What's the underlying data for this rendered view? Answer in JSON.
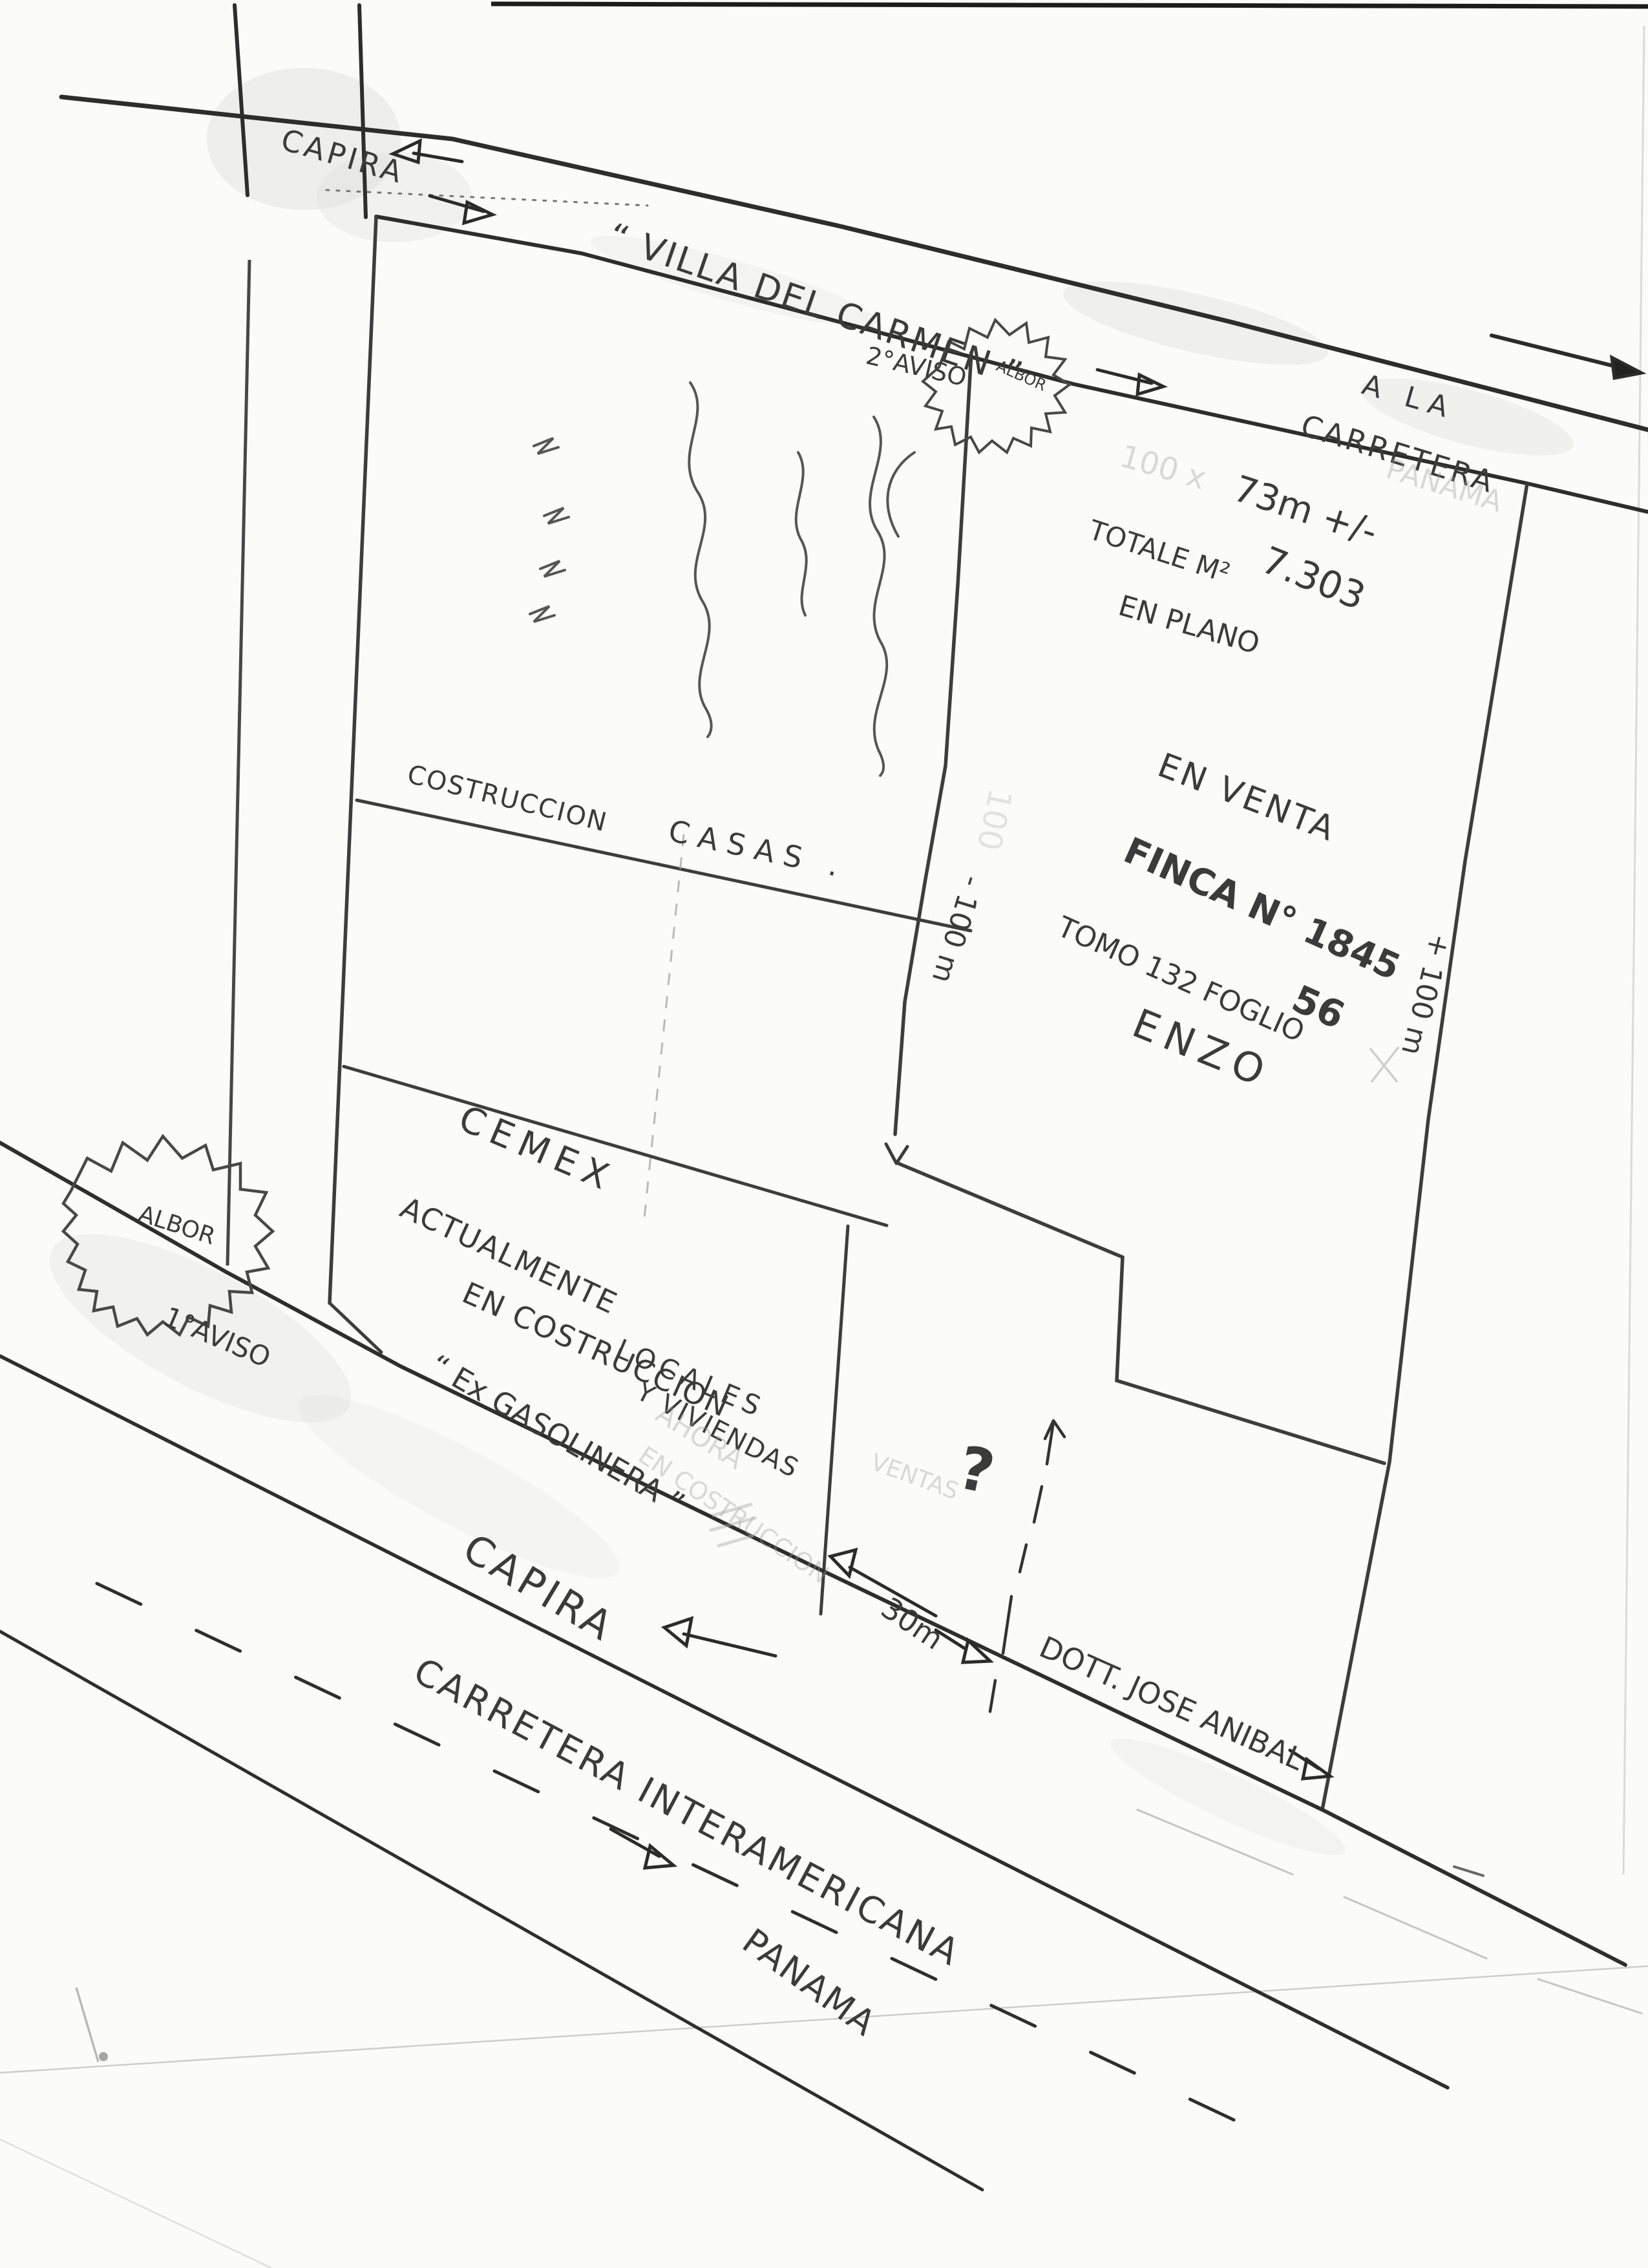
{
  "top_road": {
    "capira": "CAPIRA",
    "villa_del_carmen": "“ VILLA DEL CARMEN ”",
    "aviso2": "2°AVISO",
    "albor": "ALBOR",
    "a_la": "A LA",
    "carretera": "CARRETERA",
    "panama_faint": "PANAMA"
  },
  "right_parcel": {
    "faint_100x": "100 x",
    "width_dim": "73m +/-",
    "totale_label": "TOTALE M²",
    "totale_value": "7.303",
    "en_plano": "EN PLANO",
    "en_venta": "EN VENTA",
    "finca": "FINCA N° 1845",
    "tomo": "TOMO 132 FOGLIO",
    "foglio_num": "56",
    "owner": "ENZO",
    "depth_right": "+ 100 m",
    "depth_middle": "- 100 m",
    "faint_100": "100"
  },
  "left_parcel": {
    "costruccion": "COSTRUCCION",
    "casas": "CASAS .",
    "cemex": "CEMEX",
    "actualmente": "ACTUALMENTE",
    "en_costruccion": "EN COSTRUCCION",
    "locales": "LOCALES",
    "y_viviendas": "Y VIVIENDAS",
    "ex_gasolinera": "“ Ex GASOLINERA ”",
    "ahora_faint": "AHORA",
    "en_costruccion_faint": "EN COSTRUCCION"
  },
  "left_side": {
    "albor": "ALBOR",
    "aviso1": "1°AVISO"
  },
  "lower_area": {
    "ventas_faint": "VENTAS",
    "question_mark": "?",
    "frontage_dim": "30m",
    "owner_note": "DOTT. JOSE ANIBAL",
    "capira": "CAPIRA",
    "carretera_interamericana": "CARRETERA INTERAMERICANA",
    "panama": "PANAMA"
  }
}
